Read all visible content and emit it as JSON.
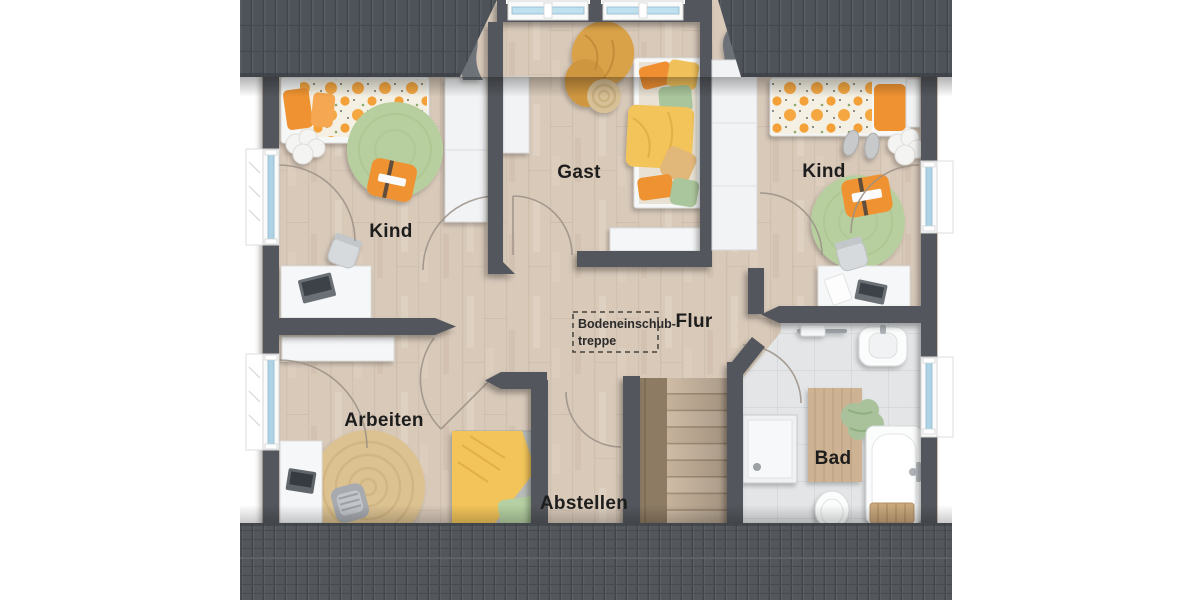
{
  "plan": {
    "rooms": [
      {
        "id": "kind-left",
        "label": "Kind"
      },
      {
        "id": "gast",
        "label": "Gast"
      },
      {
        "id": "kind-right",
        "label": "Kind"
      },
      {
        "id": "flur",
        "label": "Flur"
      },
      {
        "id": "arbeiten",
        "label": "Arbeiten"
      },
      {
        "id": "abstellen",
        "label": "Abstellen"
      },
      {
        "id": "bad",
        "label": "Bad"
      }
    ],
    "attic_hatch": {
      "line1": "Bodeneinschub-",
      "line2": "treppe"
    }
  },
  "colors": {
    "roof": "#4e535a",
    "wall": "#53575c",
    "floor_wood": "#d8c9b9",
    "floor_tile": "#e3e5e7",
    "window_glass": "#aed3e6",
    "accent_orange": "#f09336",
    "accent_yellow": "#f2c45a",
    "accent_green": "#b7cf9e",
    "accent_sage": "#a9c29c",
    "furniture_white": "#f6f7f8",
    "jute": "#dcc291",
    "stair_wood": "#cbb7a0"
  },
  "furniture": [
    "bed",
    "wardrobe",
    "round-rug",
    "floor-cushion",
    "desk",
    "desk-chair",
    "cloud-rug",
    "sideboard",
    "daybed",
    "jute-rug",
    "armchair",
    "laptop",
    "pouf",
    "basket",
    "curtain",
    "staircase",
    "handrail",
    "shower",
    "sink",
    "towel-rail",
    "bathtub",
    "toilet",
    "bath-mat",
    "stool",
    "towel",
    "slippers",
    "window",
    "door-arc"
  ]
}
